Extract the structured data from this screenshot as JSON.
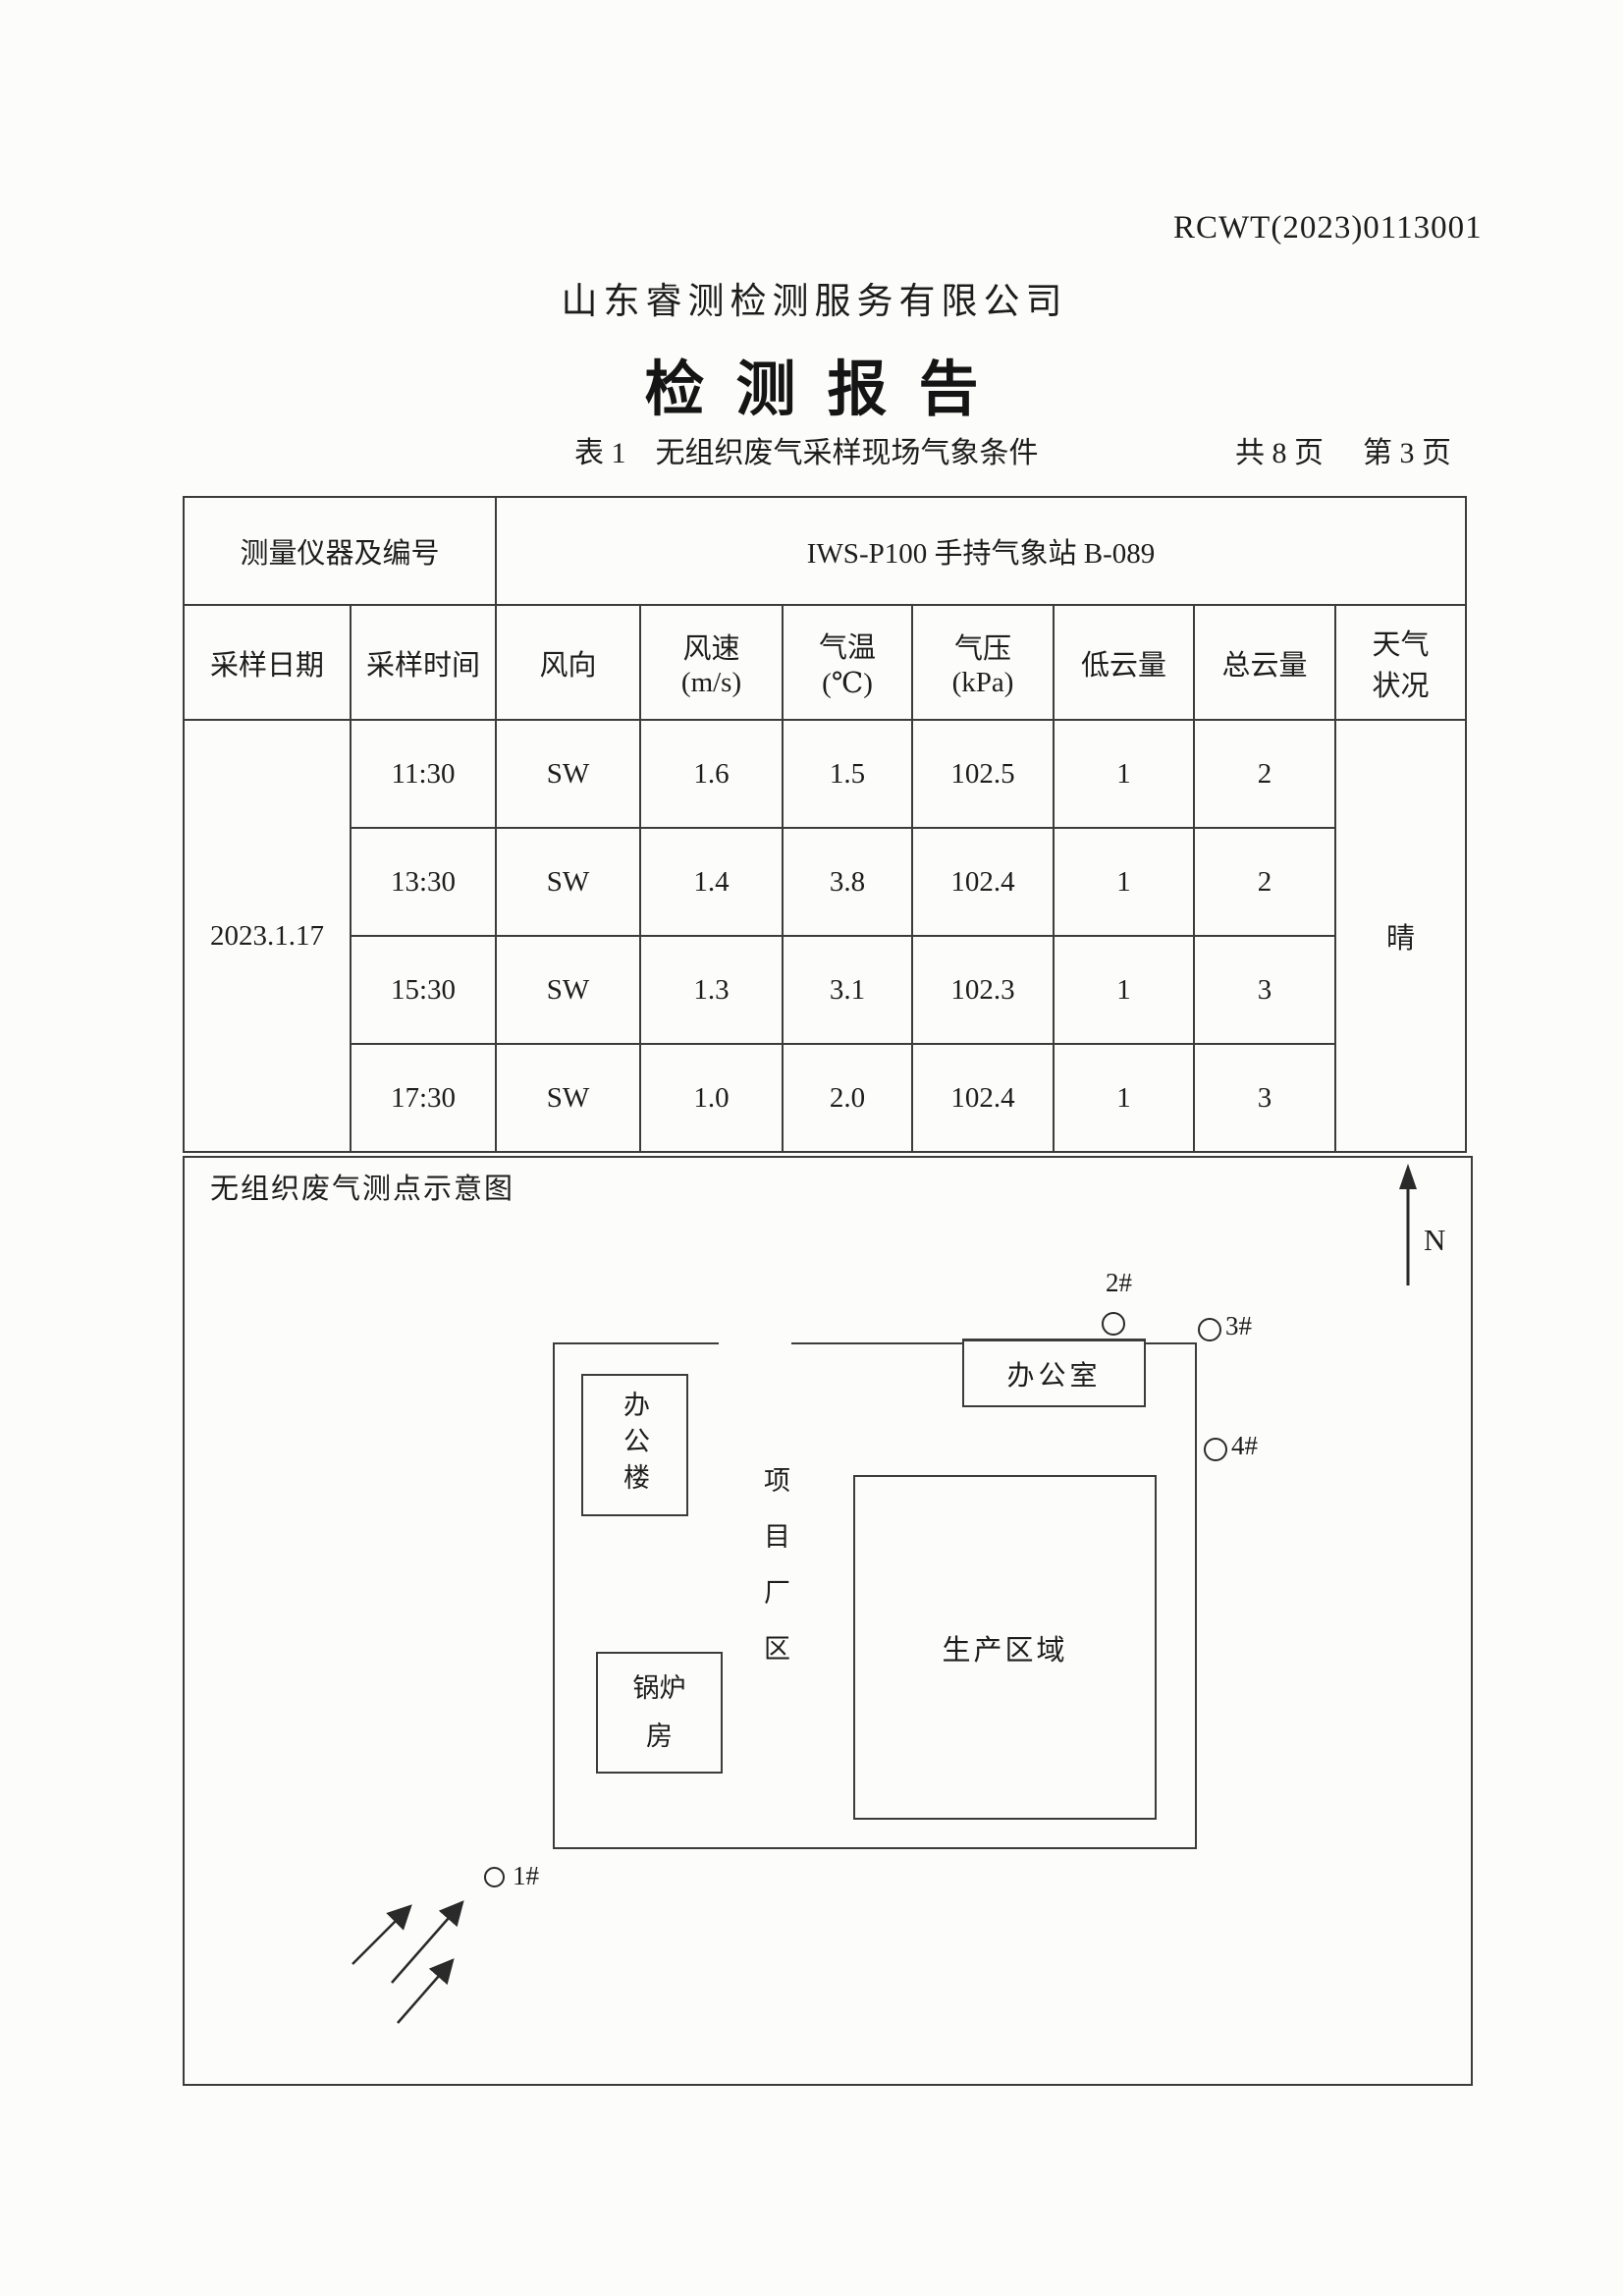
{
  "page": {
    "report_number": "RCWT(2023)0113001",
    "company_name": "山东睿测检测服务有限公司",
    "report_title": "检测报告",
    "table_caption": "表 1　无组织废气采样现场气象条件",
    "page_total": "共 8 页",
    "page_current": "第 3 页"
  },
  "colors": {
    "paper": "#fcfcfa",
    "ink": "#1d1d1d",
    "border": "#3c3c3c"
  },
  "weather_table": {
    "instrument_label": "测量仪器及编号",
    "instrument_value": "IWS-P100 手持气象站 B-089",
    "columns": [
      "采样日期",
      "采样时间",
      "风向",
      "风速\n(m/s)",
      "气温\n(℃)",
      "气压\n(kPa)",
      "低云量",
      "总云量",
      "天气\n状况"
    ],
    "date": "2023.1.17",
    "weather": "晴",
    "rows": [
      {
        "time": "11:30",
        "wind_direction": "SW",
        "wind_speed": "1.6",
        "temperature": "1.5",
        "pressure": "102.5",
        "low_cloud": "1",
        "total_cloud": "2"
      },
      {
        "time": "13:30",
        "wind_direction": "SW",
        "wind_speed": "1.4",
        "temperature": "3.8",
        "pressure": "102.4",
        "low_cloud": "1",
        "total_cloud": "2"
      },
      {
        "time": "15:30",
        "wind_direction": "SW",
        "wind_speed": "1.3",
        "temperature": "3.1",
        "pressure": "102.3",
        "low_cloud": "1",
        "total_cloud": "3"
      },
      {
        "time": "17:30",
        "wind_direction": "SW",
        "wind_speed": "1.0",
        "temperature": "2.0",
        "pressure": "102.4",
        "low_cloud": "1",
        "total_cloud": "3"
      }
    ]
  },
  "diagram": {
    "caption": "无组织废气测点示意图",
    "north_label": "N",
    "site_label": "项目厂区",
    "buildings": {
      "office_building": "办公楼",
      "office_room": "办公室",
      "boiler_room": "锅炉\n房",
      "production_area": "生产区域"
    },
    "sampling_points": [
      {
        "id": "1#"
      },
      {
        "id": "2#"
      },
      {
        "id": "3#"
      },
      {
        "id": "4#"
      }
    ]
  }
}
